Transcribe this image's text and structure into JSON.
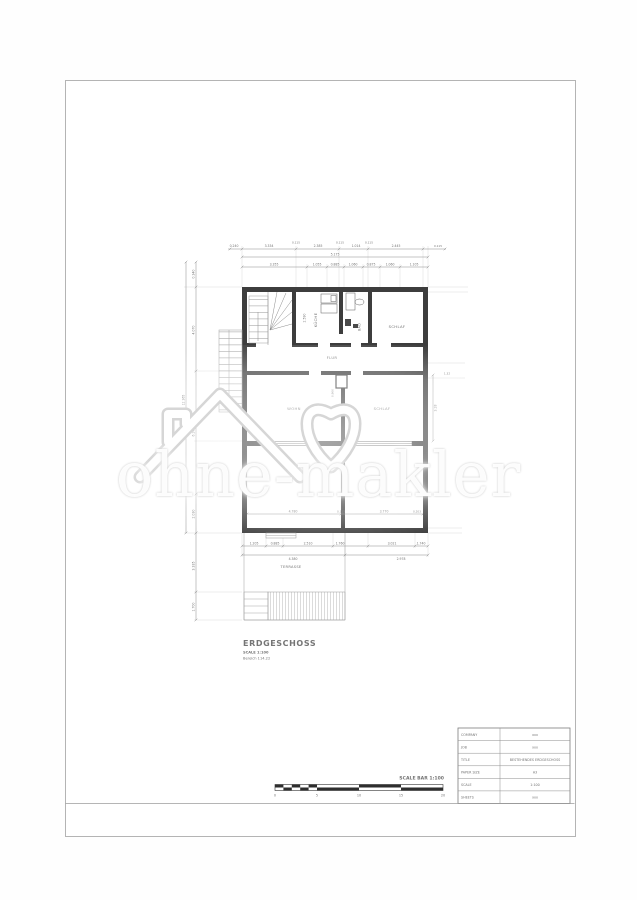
{
  "watermark": {
    "text": "ohne-makler"
  },
  "plan": {
    "title_block": {
      "title": "ERDGESCHOSS",
      "scale_note": "SCALE 1:100",
      "area_note": "Bereich 114.22"
    },
    "rooms": {
      "kueche": "KÜCHE",
      "bad": "BAD",
      "schlaf1": "SCHLAF",
      "flur": "FLUR",
      "wohn": "WOHN",
      "schlaf2": "SCHLAF",
      "terrasse": "TERRASSE"
    },
    "dims": {
      "top1": [
        "0.240",
        "3.334",
        "0.115",
        "2.385",
        "0.115",
        "1.014",
        "0.115",
        "2.445",
        "0.115"
      ],
      "top2": [
        "5.175"
      ],
      "top3": [
        "3.355",
        "1.055",
        "0.885",
        "1.060",
        "0.875",
        "1.060",
        "1.105"
      ],
      "left": [
        "12.365",
        "0.340",
        "4.070",
        "6.240",
        "2.030",
        "3.335",
        "1.700"
      ],
      "right": [
        "1.32",
        "3.28"
      ],
      "bottom1": [
        "1.205",
        "0.885",
        "2.510",
        "1.760",
        "3.021",
        "1.740"
      ],
      "bottom2": [
        "4.380",
        "2.978"
      ],
      "inner": [
        "4.780",
        "0.115",
        "3.770",
        "0.203",
        "2.590",
        "0.960"
      ]
    }
  },
  "scalebar": {
    "label": "SCALE BAR 1:100",
    "ticks": [
      "0",
      "5",
      "10",
      "15",
      "20"
    ]
  },
  "titleblock": {
    "rows": [
      {
        "label": "COMPANY",
        "value": "xxx"
      },
      {
        "label": "JOB",
        "value": "xxx"
      },
      {
        "label": "TITLE",
        "value": "BESTEHENDES ERDGESCHOSS"
      },
      {
        "label": "PAPER SIZE",
        "value": "A3"
      },
      {
        "label": "SCALE",
        "value": "1:100"
      },
      {
        "label": "SHEETS",
        "value": "xxx"
      }
    ]
  },
  "colors": {
    "wall": "#3d3d3d",
    "dimension": "#8c8c8c",
    "sheet_border": "#b4b4b4",
    "watermark": "#e9e9e9"
  }
}
